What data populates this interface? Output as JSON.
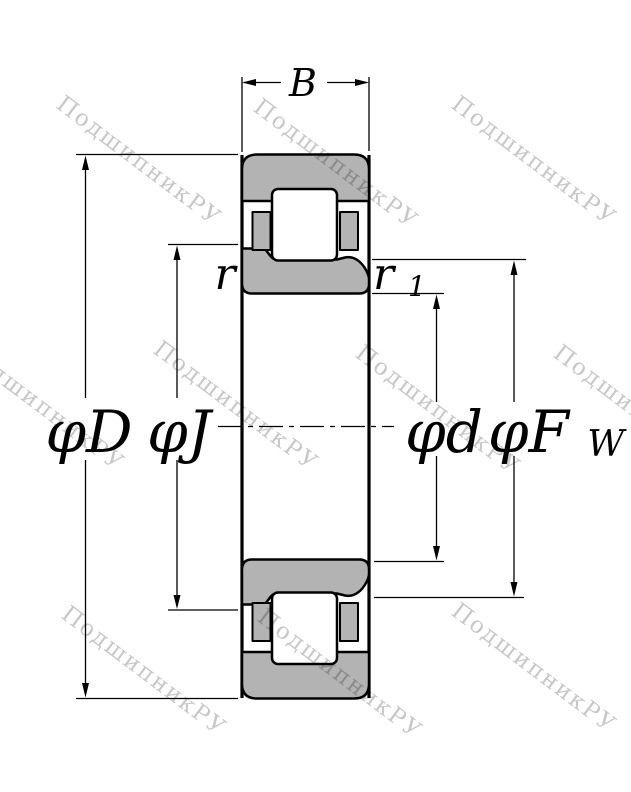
{
  "drawing": {
    "title": "cylindrical-roller-bearing-cross-section",
    "labels": {
      "width": "B",
      "outer_diameter": "φD",
      "flange_diameter": "φJ",
      "bore_diameter": "φd",
      "raceway_diameter_main": "φF",
      "raceway_diameter_sub": "W",
      "chamfer_outer": "r",
      "chamfer_inner_main": "r",
      "chamfer_inner_sub": "1"
    },
    "colors": {
      "ring_fill": "#b3b3b3",
      "outline": "#000000",
      "background": "#ffffff",
      "watermark": "rgba(0,0,0,0.22)"
    }
  },
  "watermark": {
    "text": "ПодшипникРУ",
    "angle": 37,
    "font_size": 23,
    "positions": [
      [
        55,
        107
      ],
      [
        252,
        110
      ],
      [
        450,
        107
      ],
      [
        -42,
        352
      ],
      [
        152,
        352
      ],
      [
        354,
        356
      ],
      [
        552,
        356
      ],
      [
        60,
        617
      ],
      [
        256,
        620
      ],
      [
        450,
        614
      ]
    ]
  }
}
